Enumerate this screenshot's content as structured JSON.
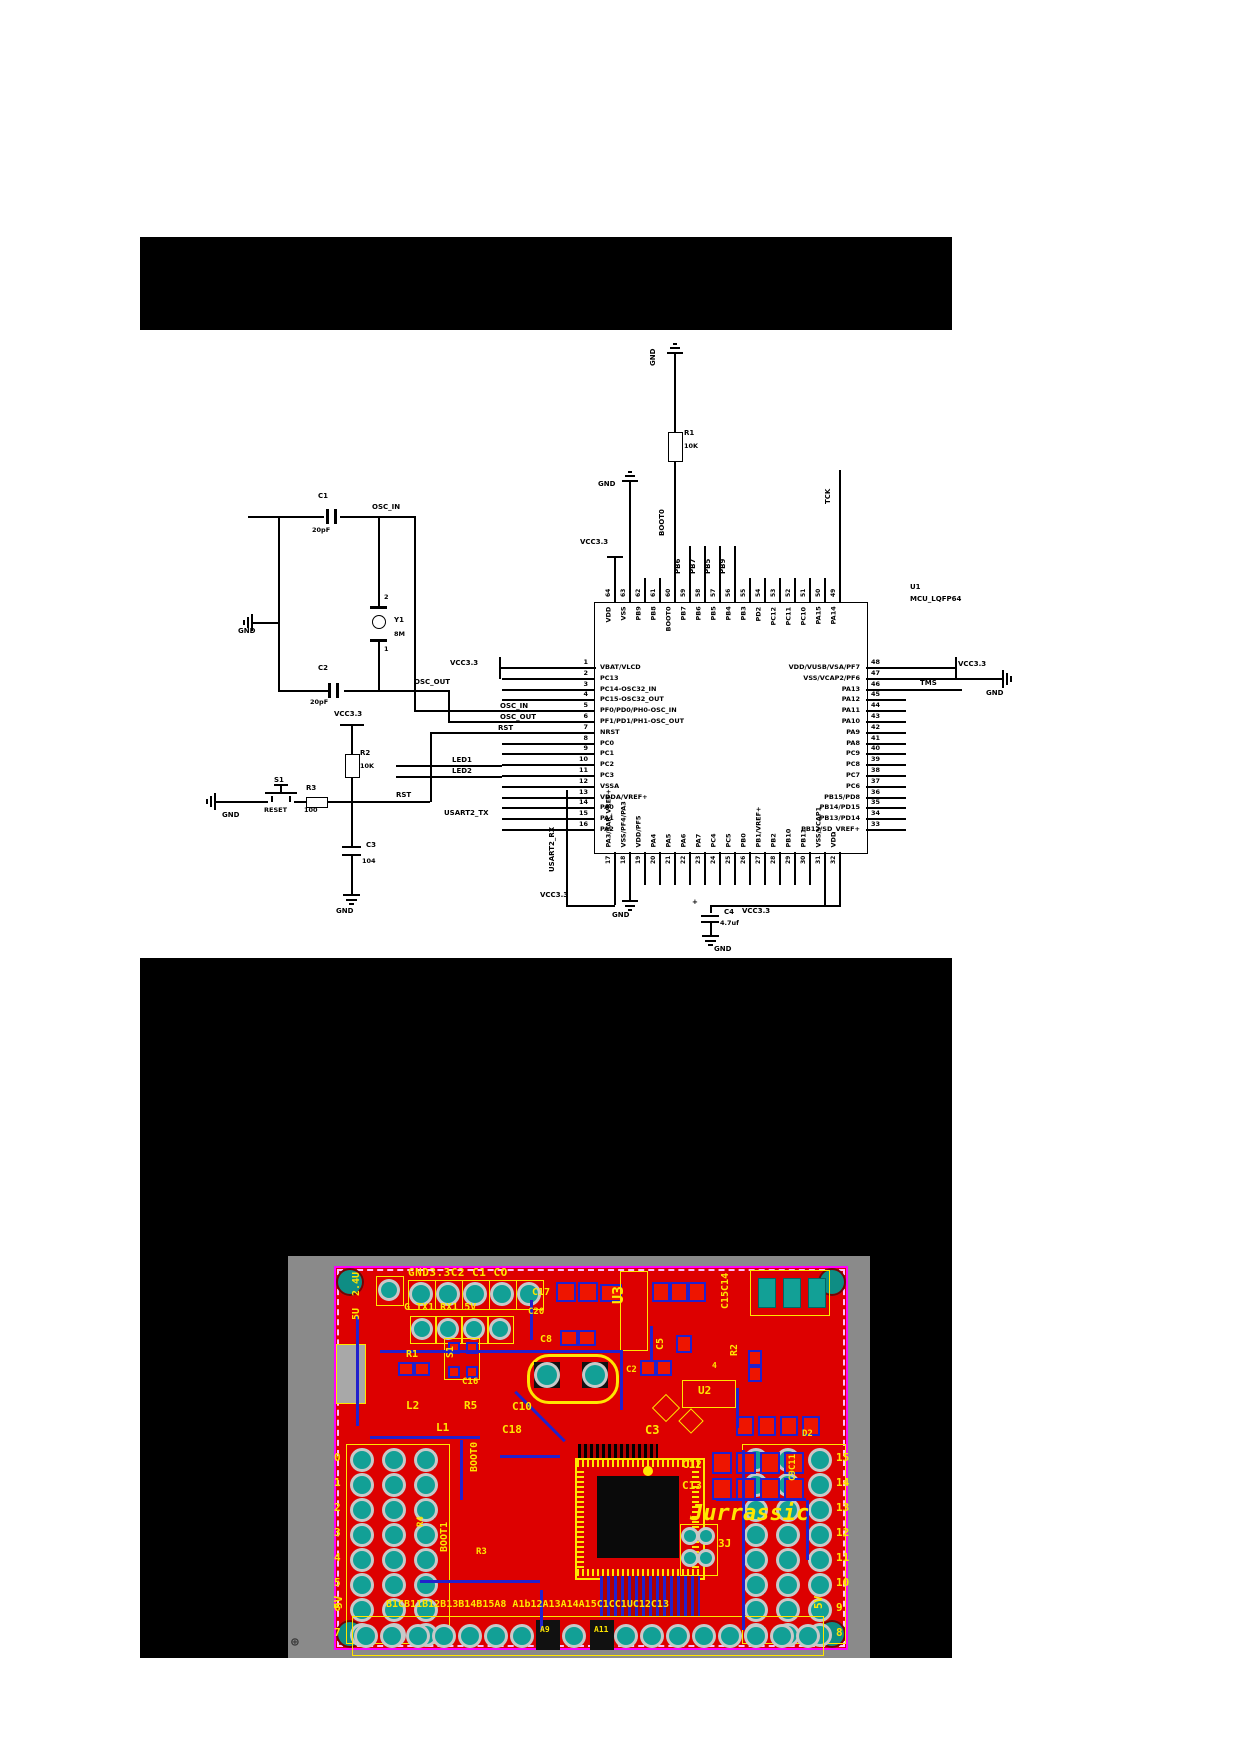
{
  "schematic": {
    "mcu": {
      "ref": "U1",
      "part": "MCU_LQFP64",
      "left_pins": [
        {
          "n": 1,
          "label": "VBAT/VLCD"
        },
        {
          "n": 2,
          "label": "PC13"
        },
        {
          "n": 3,
          "label": "PC14-OSC32_IN"
        },
        {
          "n": 4,
          "label": "PC15-OSC32_OUT"
        },
        {
          "n": 5,
          "label": "PF0/PD0/PH0-OSC_IN"
        },
        {
          "n": 6,
          "label": "PF1/PD1/PH1-OSC_OUT"
        },
        {
          "n": 7,
          "label": "NRST"
        },
        {
          "n": 8,
          "label": "PC0"
        },
        {
          "n": 9,
          "label": "PC1"
        },
        {
          "n": 10,
          "label": "PC2"
        },
        {
          "n": 11,
          "label": "PC3"
        },
        {
          "n": 12,
          "label": "VSSA"
        },
        {
          "n": 13,
          "label": "VDDA/VREF+"
        },
        {
          "n": 14,
          "label": "PA0"
        },
        {
          "n": 15,
          "label": "PA1"
        },
        {
          "n": 16,
          "label": "PA2"
        }
      ],
      "right_pins": [
        {
          "n": 48,
          "label": "VDD/VUSB/VSA/PF7"
        },
        {
          "n": 47,
          "label": "VSS/VCAP2/PF6"
        },
        {
          "n": 46,
          "label": "PA13"
        },
        {
          "n": 45,
          "label": "PA12"
        },
        {
          "n": 44,
          "label": "PA11"
        },
        {
          "n": 43,
          "label": "PA10"
        },
        {
          "n": 42,
          "label": "PA9"
        },
        {
          "n": 41,
          "label": "PA8"
        },
        {
          "n": 40,
          "label": "PC9"
        },
        {
          "n": 39,
          "label": "PC8"
        },
        {
          "n": 38,
          "label": "PC7"
        },
        {
          "n": 37,
          "label": "PC6"
        },
        {
          "n": 36,
          "label": "PB15/PD8"
        },
        {
          "n": 35,
          "label": "PB14/PD15"
        },
        {
          "n": 34,
          "label": "PB13/PD14"
        },
        {
          "n": 33,
          "label": "PB12/SD_VREF+"
        }
      ],
      "top_pins": [
        {
          "n": 64,
          "label": "VDD"
        },
        {
          "n": 63,
          "label": "VSS"
        },
        {
          "n": 62,
          "label": "PB9"
        },
        {
          "n": 61,
          "label": "PB8"
        },
        {
          "n": 60,
          "label": "BOOT0"
        },
        {
          "n": 59,
          "label": "PB7"
        },
        {
          "n": 58,
          "label": "PB6"
        },
        {
          "n": 57,
          "label": "PB5"
        },
        {
          "n": 56,
          "label": "PB4"
        },
        {
          "n": 55,
          "label": "PB3"
        },
        {
          "n": 54,
          "label": "PD2"
        },
        {
          "n": 53,
          "label": "PC12"
        },
        {
          "n": 52,
          "label": "PC11"
        },
        {
          "n": 51,
          "label": "PC10"
        },
        {
          "n": 50,
          "label": "PA15"
        },
        {
          "n": 49,
          "label": "PA14"
        }
      ],
      "bottom_pins": [
        {
          "n": 17,
          "label": "PA3/SAR_VREF+"
        },
        {
          "n": 18,
          "label": "VSS/PF4/PA3"
        },
        {
          "n": 19,
          "label": "VDD/PF5"
        },
        {
          "n": 20,
          "label": "PA4"
        },
        {
          "n": 21,
          "label": "PA5"
        },
        {
          "n": 22,
          "label": "PA6"
        },
        {
          "n": 23,
          "label": "PA7"
        },
        {
          "n": 24,
          "label": "PC4"
        },
        {
          "n": 25,
          "label": "PC5"
        },
        {
          "n": 26,
          "label": "PB0"
        },
        {
          "n": 27,
          "label": "PB1/VREF+"
        },
        {
          "n": 28,
          "label": "PB2"
        },
        {
          "n": 29,
          "label": "PB10"
        },
        {
          "n": 30,
          "label": "PB11"
        },
        {
          "n": 31,
          "label": "VSS/VCAP1"
        },
        {
          "n": 32,
          "label": "VDD"
        }
      ]
    },
    "components": {
      "r1": {
        "ref": "R1",
        "value": "10K"
      },
      "r2": {
        "ref": "R2",
        "value": "10K"
      },
      "r3": {
        "ref": "R3",
        "value": "100"
      },
      "c1": {
        "ref": "C1",
        "value": "20pF"
      },
      "c2": {
        "ref": "C2",
        "value": "20pF"
      },
      "c3": {
        "ref": "C3",
        "value": "104"
      },
      "c4": {
        "ref": "C4",
        "value": "4.7uf",
        "polarity": "+"
      },
      "y1": {
        "ref": "Y1",
        "value": "8M",
        "pin_top": "2",
        "pin_bottom": "1"
      },
      "s1": {
        "ref": "S1",
        "label": "RESET"
      }
    },
    "net_labels": {
      "vcc": "VCC3.3",
      "gnd": "GND",
      "osc_in": "OSC_IN",
      "osc_out": "OSC_OUT",
      "rst": "RST",
      "led1": "LED1",
      "led2": "LED2",
      "tms": "TMS",
      "tck": "TCK",
      "boot0": "BOOT0",
      "usart_tx": "USART2_TX",
      "usart_rx": "USART2_RX",
      "pb6": "PB6",
      "pb7": "PB7",
      "pb5": "PB5",
      "pb9": "PB9"
    }
  },
  "pcb": {
    "colors": {
      "board": "#dd0000",
      "silk": "#ffe600",
      "trace": "#2121cc",
      "hole": "#12a096",
      "ring": "#c8c8c8",
      "border": "#ff00ff",
      "bg": "#8a8a8a",
      "pad": "#ee1500"
    },
    "silkscreen": {
      "top_text": "GND3.3C2 C1 CO",
      "row2": "G TX1 RX1 5V",
      "c17": "C17",
      "c20": "C20",
      "u3": "U3",
      "c15c14": "C15C14",
      "c8": "C8",
      "c5": "C5",
      "c2": "C2",
      "r1": "R1",
      "s1": "S1",
      "r2": "R2",
      "four": "4",
      "u2": "U2",
      "c16": "C16",
      "l2": "L2",
      "r5": "R5",
      "c10": "C10",
      "l1": "L1",
      "c18": "C18",
      "c3": "C3",
      "c12": "C12",
      "c13": "C13",
      "boot0": "BOOT0",
      "boot1": "BOOT1",
      "r4": "R4",
      "r3": "R3",
      "j3": "3J",
      "c9c11": "C9C11",
      "d2": "D2",
      "v24": "2.4U",
      "v5a": "5U",
      "v5b": "5V",
      "v5c": "5V",
      "bottom_row": "B1CB11B12B13B14B15A8 A1b12A13A14A15C1CC1UC12C13",
      "a9": "A9",
      "a11": "A11",
      "brand": "Jurrassic",
      "reg_mark": "⊕"
    },
    "left_header_numbers": [
      "0",
      "1",
      "2",
      "3",
      "4",
      "5",
      "6",
      "7"
    ],
    "right_header_numbers": [
      "15",
      "14",
      "13",
      "12",
      "11",
      "10",
      "9",
      "8"
    ]
  }
}
